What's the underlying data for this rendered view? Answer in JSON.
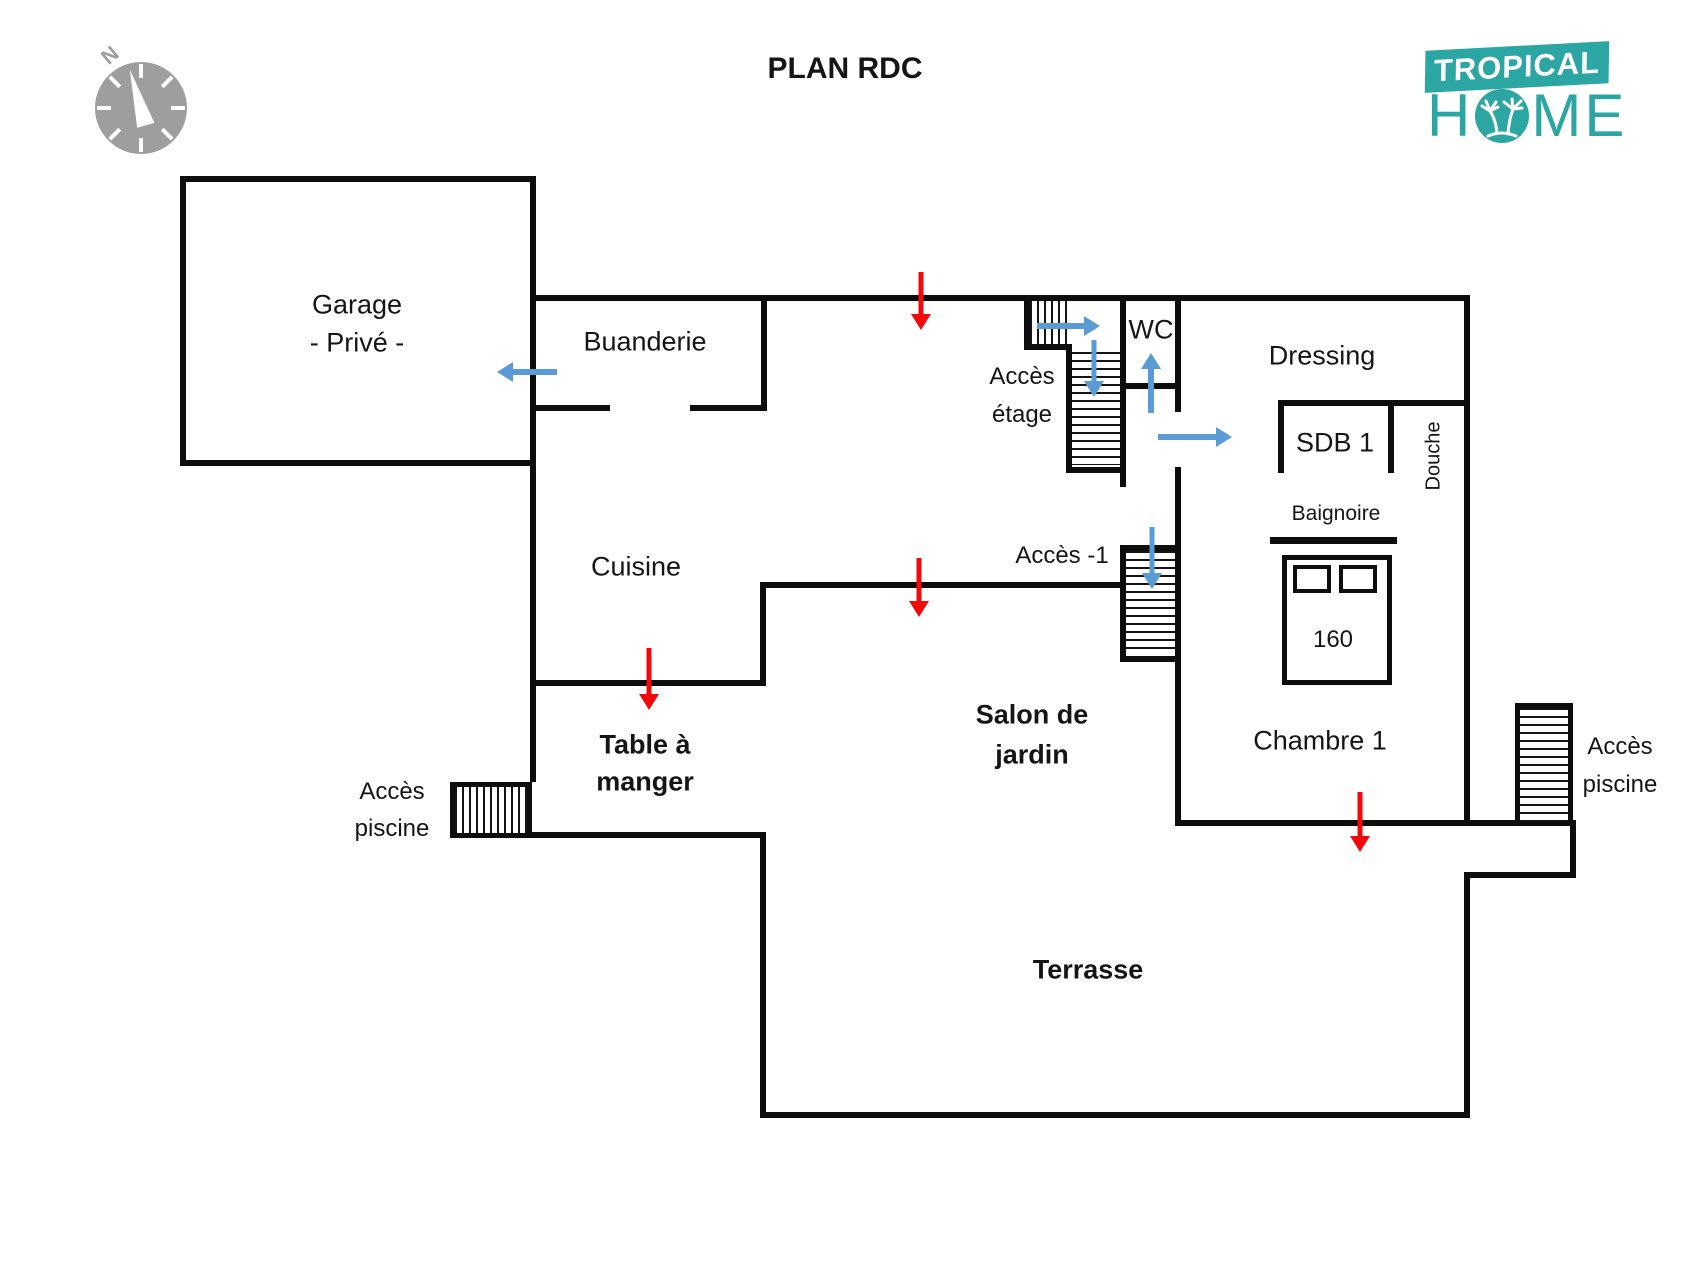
{
  "title": "PLAN RDC",
  "logo": {
    "tropical": "TROPICAL",
    "home_h": "H",
    "home_me": "ME"
  },
  "compass": {
    "north": "N"
  },
  "rooms": {
    "garage_l1": "Garage",
    "garage_l2": "- Privé -",
    "buanderie": "Buanderie",
    "cuisine": "Cuisine",
    "wc": "WC",
    "dressing": "Dressing",
    "sdb1": "SDB 1",
    "douche": "Douche",
    "chambre1": "Chambre 1",
    "table_l1": "Table à",
    "table_l2": "manger",
    "salon_l1": "Salon de",
    "salon_l2": "jardin",
    "terrasse": "Terrasse"
  },
  "annotations": {
    "etage_l1": "Accès",
    "etage_l2": "étage",
    "m1": "Accès -1",
    "piscine_left_l1": "Accès",
    "piscine_left_l2": "piscine",
    "piscine_right_l1": "Accès",
    "piscine_right_l2": "piscine",
    "baignoire": "Baignoire",
    "bed_size": "160"
  },
  "arrows": {
    "red_entries": [
      "buanderie-top",
      "salon-de-jardin",
      "table-a-manger",
      "chambre1"
    ],
    "blue_paths": [
      "buanderie-to-garage",
      "stairs-landing-right",
      "landing-down-etage",
      "hall-up-wc",
      "hall-right-dressing",
      "hall-down-m1"
    ]
  },
  "colors": {
    "teal": "#2ca6a3",
    "blue": "#5b9bd5",
    "red": "#f20a0a",
    "wall": "#0d0d0d",
    "gray": "#9e9e9e"
  }
}
